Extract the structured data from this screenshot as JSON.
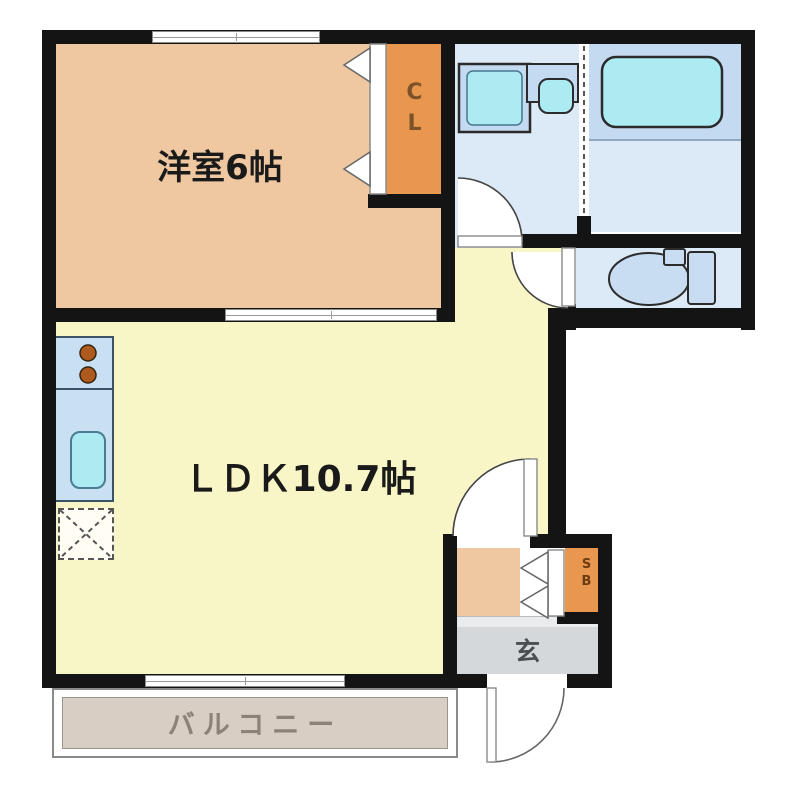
{
  "floor_plan": {
    "rooms": {
      "western_room": {
        "label": "洋室6帖"
      },
      "closet": {
        "label": "CL"
      },
      "ldk": {
        "label": "ＬＤＫ10.7帖"
      },
      "entrance": {
        "label": "玄"
      },
      "shoe_box": {
        "label": "SB"
      },
      "balcony": {
        "label": "バルコニー"
      }
    },
    "colors": {
      "wall": "#141414",
      "western": "#EFC8A1",
      "closet": "#E9974E",
      "ldk": "#F8F6C6",
      "wet": "#DCEAF7",
      "platform": "#C4DAF0",
      "fixture": "#C9DDF2",
      "water": "#ADEBF2",
      "counter": "#C9DFF2",
      "entrance": "#D4D8DB",
      "balcony": "#D8CEC3",
      "burner": "#AE5A1E"
    }
  }
}
